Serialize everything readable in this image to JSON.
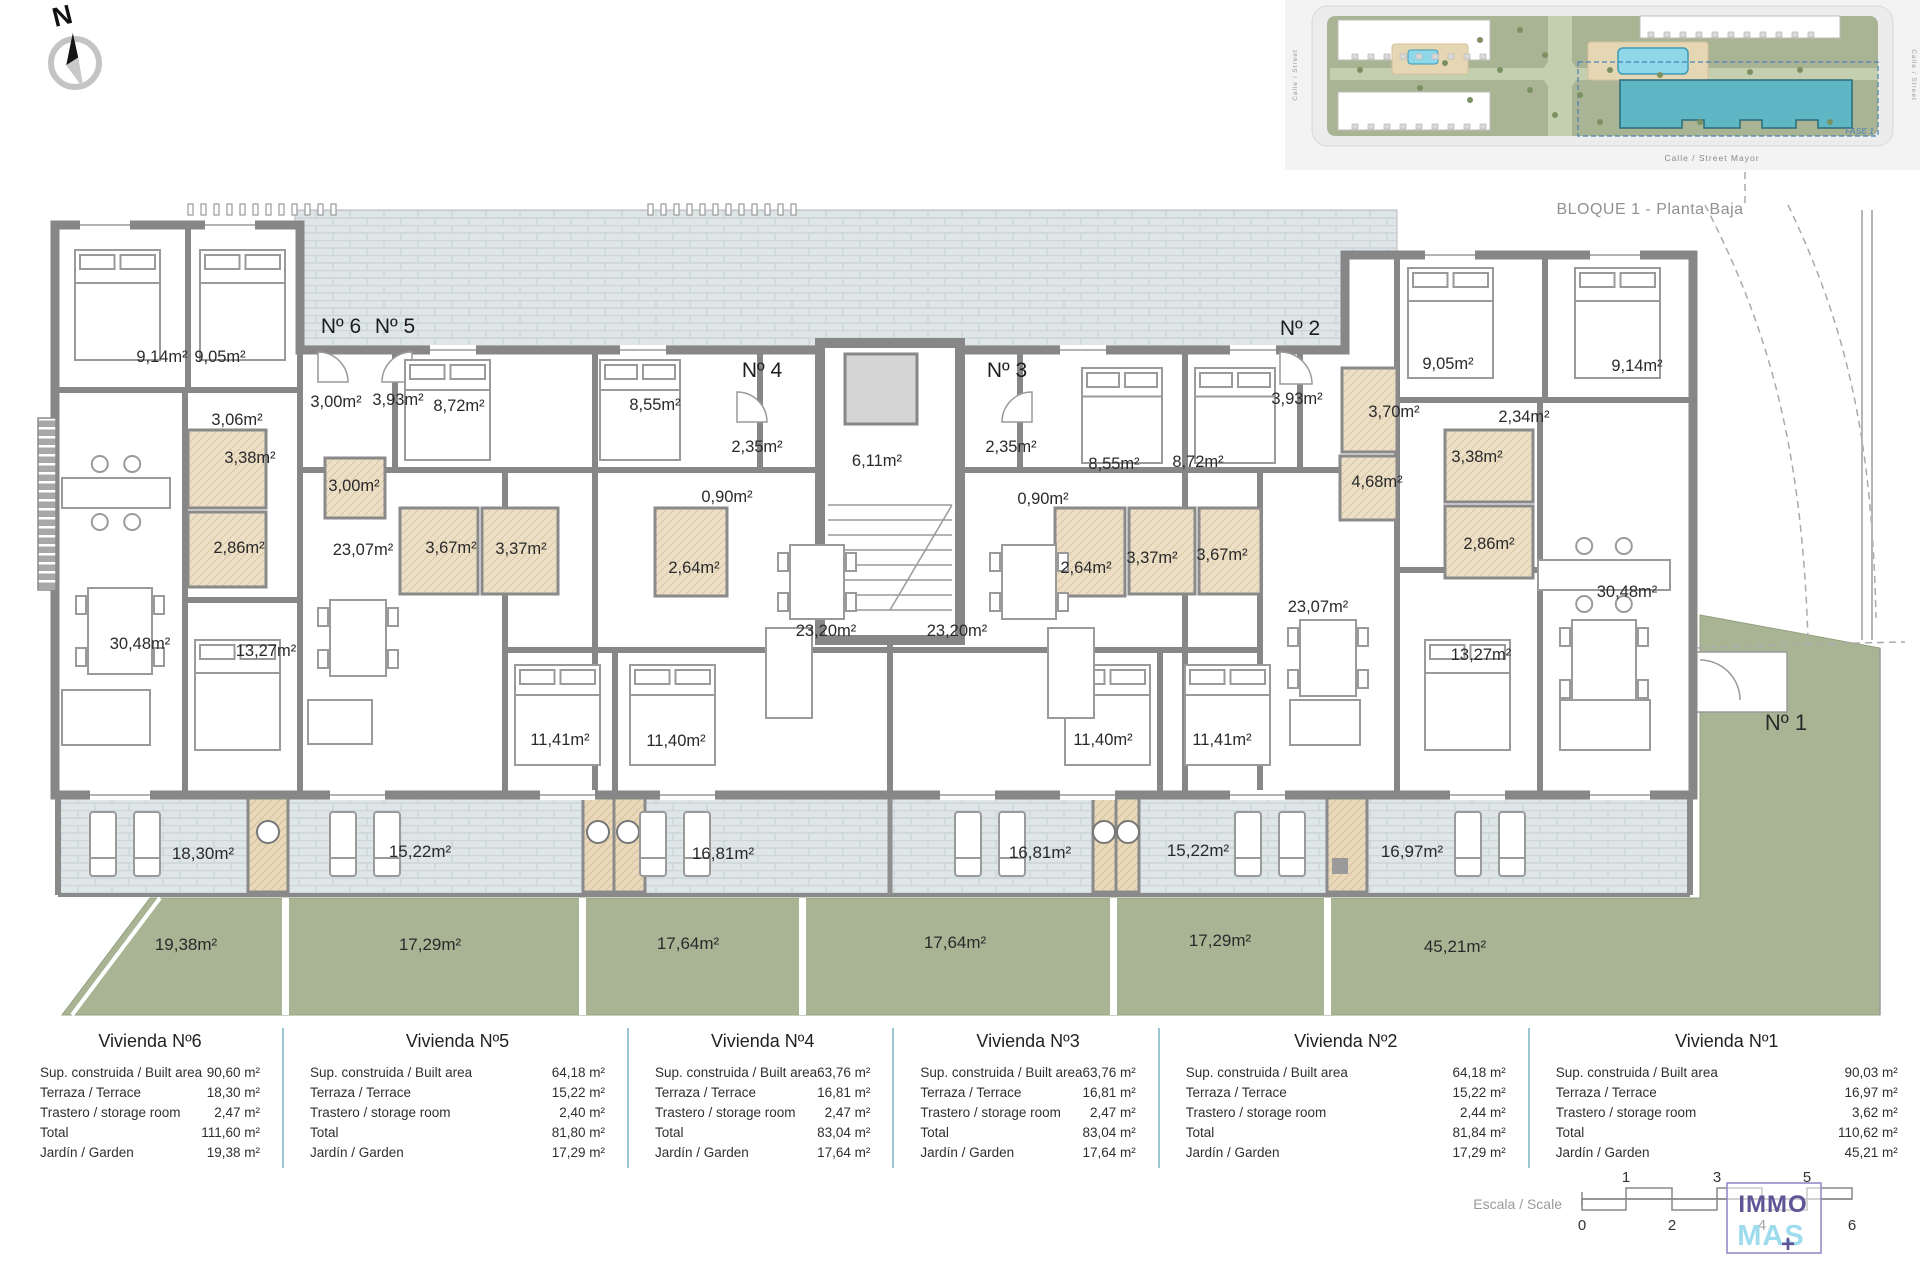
{
  "title": "BLOQUE 1 - Planta Baja",
  "compass": {
    "north_label": "N"
  },
  "site_inset": {
    "street_bottom": "Calle / Street Mayor",
    "street_left": "Calle / Street",
    "street_right": "Calle / Street",
    "fase_label": "FASE 1"
  },
  "colors": {
    "wall": "#878787",
    "tile": "#dee6e8",
    "garden": "#a9b495",
    "bath": "#ecdfc6",
    "storage": "#e9d9ba",
    "highlight_building": "#5fb7c5",
    "table_divider": "#9cc7d0",
    "logo_purple": "#5f5596",
    "logo_cyan": "#9edced",
    "fase_blue": "#4a7fb5"
  },
  "floorplan": {
    "labels": [
      {
        "t": "Nº 6",
        "x": 341,
        "y": 333,
        "k": "entry"
      },
      {
        "t": "Nº 5",
        "x": 395,
        "y": 333,
        "k": "entry"
      },
      {
        "t": "Nº 4",
        "x": 762,
        "y": 377,
        "k": "entry"
      },
      {
        "t": "Nº 3",
        "x": 1007,
        "y": 377,
        "k": "entry"
      },
      {
        "t": "Nº 2",
        "x": 1300,
        "y": 335,
        "k": "entry"
      },
      {
        "t": "Nº 1",
        "x": 1786,
        "y": 730,
        "k": "n1"
      },
      {
        "t": "9,14m²",
        "x": 162,
        "y": 362,
        "k": "room"
      },
      {
        "t": "9,05m²",
        "x": 220,
        "y": 362,
        "k": "room"
      },
      {
        "t": "3,06m²",
        "x": 237,
        "y": 425,
        "k": "room"
      },
      {
        "t": "3,38m²",
        "x": 250,
        "y": 463,
        "k": "room"
      },
      {
        "t": "2,86m²",
        "x": 239,
        "y": 553,
        "k": "room"
      },
      {
        "t": "30,48m²",
        "x": 140,
        "y": 649,
        "k": "room"
      },
      {
        "t": "13,27m²",
        "x": 266,
        "y": 656,
        "k": "room"
      },
      {
        "t": "3,00m²",
        "x": 336,
        "y": 407,
        "k": "room"
      },
      {
        "t": "3,93m²",
        "x": 398,
        "y": 405,
        "k": "room"
      },
      {
        "t": "8,72m²",
        "x": 459,
        "y": 411,
        "k": "room"
      },
      {
        "t": "8,55m²",
        "x": 655,
        "y": 410,
        "k": "room"
      },
      {
        "t": "3,00m²",
        "x": 354,
        "y": 491,
        "k": "room"
      },
      {
        "t": "23,07m²",
        "x": 363,
        "y": 555,
        "k": "room"
      },
      {
        "t": "3,67m²",
        "x": 451,
        "y": 553,
        "k": "room"
      },
      {
        "t": "3,37m²",
        "x": 521,
        "y": 554,
        "k": "room"
      },
      {
        "t": "2,64m²",
        "x": 694,
        "y": 573,
        "k": "room"
      },
      {
        "t": "11,41m²",
        "x": 560,
        "y": 745,
        "k": "room"
      },
      {
        "t": "11,40m²",
        "x": 676,
        "y": 746,
        "k": "room"
      },
      {
        "t": "2,35m²",
        "x": 757,
        "y": 452,
        "k": "room"
      },
      {
        "t": "0,90m²",
        "x": 727,
        "y": 502,
        "k": "room"
      },
      {
        "t": "6,11m²",
        "x": 877,
        "y": 466,
        "k": "room"
      },
      {
        "t": "23,20m²",
        "x": 826,
        "y": 636,
        "k": "room"
      },
      {
        "t": "23,20m²",
        "x": 957,
        "y": 636,
        "k": "room"
      },
      {
        "t": "2,35m²",
        "x": 1011,
        "y": 452,
        "k": "room"
      },
      {
        "t": "0,90m²",
        "x": 1043,
        "y": 504,
        "k": "room"
      },
      {
        "t": "8,55m²",
        "x": 1114,
        "y": 469,
        "k": "room"
      },
      {
        "t": "8,72m²",
        "x": 1198,
        "y": 467,
        "k": "room"
      },
      {
        "t": "2,64m²",
        "x": 1086,
        "y": 573,
        "k": "room"
      },
      {
        "t": "3,37m²",
        "x": 1152,
        "y": 563,
        "k": "room"
      },
      {
        "t": "3,67m²",
        "x": 1222,
        "y": 560,
        "k": "room"
      },
      {
        "t": "11,40m²",
        "x": 1103,
        "y": 745,
        "k": "room"
      },
      {
        "t": "11,41m²",
        "x": 1222,
        "y": 745,
        "k": "room"
      },
      {
        "t": "3,93m²",
        "x": 1297,
        "y": 404,
        "k": "room"
      },
      {
        "t": "3,70m²",
        "x": 1394,
        "y": 417,
        "k": "room"
      },
      {
        "t": "4,68m²",
        "x": 1377,
        "y": 487,
        "k": "room"
      },
      {
        "t": "23,07m²",
        "x": 1318,
        "y": 612,
        "k": "room"
      },
      {
        "t": "2,34m²",
        "x": 1524,
        "y": 422,
        "k": "room"
      },
      {
        "t": "3,38m²",
        "x": 1477,
        "y": 462,
        "k": "room"
      },
      {
        "t": "2,86m²",
        "x": 1489,
        "y": 549,
        "k": "room"
      },
      {
        "t": "9,05m²",
        "x": 1448,
        "y": 369,
        "k": "room"
      },
      {
        "t": "9,14m²",
        "x": 1637,
        "y": 371,
        "k": "room"
      },
      {
        "t": "30,48m²",
        "x": 1627,
        "y": 597,
        "k": "room"
      },
      {
        "t": "13,27m²",
        "x": 1481,
        "y": 660,
        "k": "room"
      },
      {
        "t": "18,30m²",
        "x": 203,
        "y": 859,
        "k": "terrace"
      },
      {
        "t": "15,22m²",
        "x": 420,
        "y": 857,
        "k": "terrace"
      },
      {
        "t": "16,81m²",
        "x": 723,
        "y": 859,
        "k": "terrace"
      },
      {
        "t": "16,81m²",
        "x": 1040,
        "y": 858,
        "k": "terrace"
      },
      {
        "t": "15,22m²",
        "x": 1198,
        "y": 856,
        "k": "terrace"
      },
      {
        "t": "16,97m²",
        "x": 1412,
        "y": 857,
        "k": "terrace"
      },
      {
        "t": "19,38m²",
        "x": 186,
        "y": 950,
        "k": "garden"
      },
      {
        "t": "17,29m²",
        "x": 430,
        "y": 950,
        "k": "garden"
      },
      {
        "t": "17,64m²",
        "x": 688,
        "y": 949,
        "k": "garden"
      },
      {
        "t": "17,64m²",
        "x": 955,
        "y": 948,
        "k": "garden"
      },
      {
        "t": "17,29m²",
        "x": 1220,
        "y": 946,
        "k": "garden"
      },
      {
        "t": "45,21m²",
        "x": 1455,
        "y": 952,
        "k": "garden"
      }
    ]
  },
  "tables": {
    "row_labels": [
      "Sup. construida / Built area",
      "Terraza / Terrace",
      "Trastero / storage room",
      "Total",
      "Jardín / Garden"
    ],
    "units": [
      {
        "name": "Vivienda Nº6",
        "values": [
          "90,60 m²",
          "18,30 m²",
          "2,47 m²",
          "111,60 m²",
          "19,38 m²"
        ]
      },
      {
        "name": "Vivienda Nº5",
        "values": [
          "64,18 m²",
          "15,22 m²",
          "2,40 m²",
          "81,80 m²",
          "17,29 m²"
        ]
      },
      {
        "name": "Vivienda Nº4",
        "values": [
          "63,76 m²",
          "16,81 m²",
          "2,47 m²",
          "83,04 m²",
          "17,64 m²"
        ]
      },
      {
        "name": "Vivienda Nº3",
        "values": [
          "63,76 m²",
          "16,81 m²",
          "2,47 m²",
          "83,04 m²",
          "17,64 m²"
        ]
      },
      {
        "name": "Vivienda Nº2",
        "values": [
          "64,18 m²",
          "15,22 m²",
          "2,44 m²",
          "81,84 m²",
          "17,29 m²"
        ]
      },
      {
        "name": "Vivienda Nº1",
        "values": [
          "90,03 m²",
          "16,97 m²",
          "3,62 m²",
          "110,62 m²",
          "45,21 m²"
        ]
      }
    ]
  },
  "scale_bar": {
    "label": "Escala / Scale",
    "top_numbers": [
      "1",
      "3",
      "5"
    ],
    "bottom_numbers": [
      "0",
      "2",
      "4",
      "6"
    ]
  },
  "logo": {
    "line1": "IMMO",
    "line2": "MAS",
    "plus": "+"
  }
}
